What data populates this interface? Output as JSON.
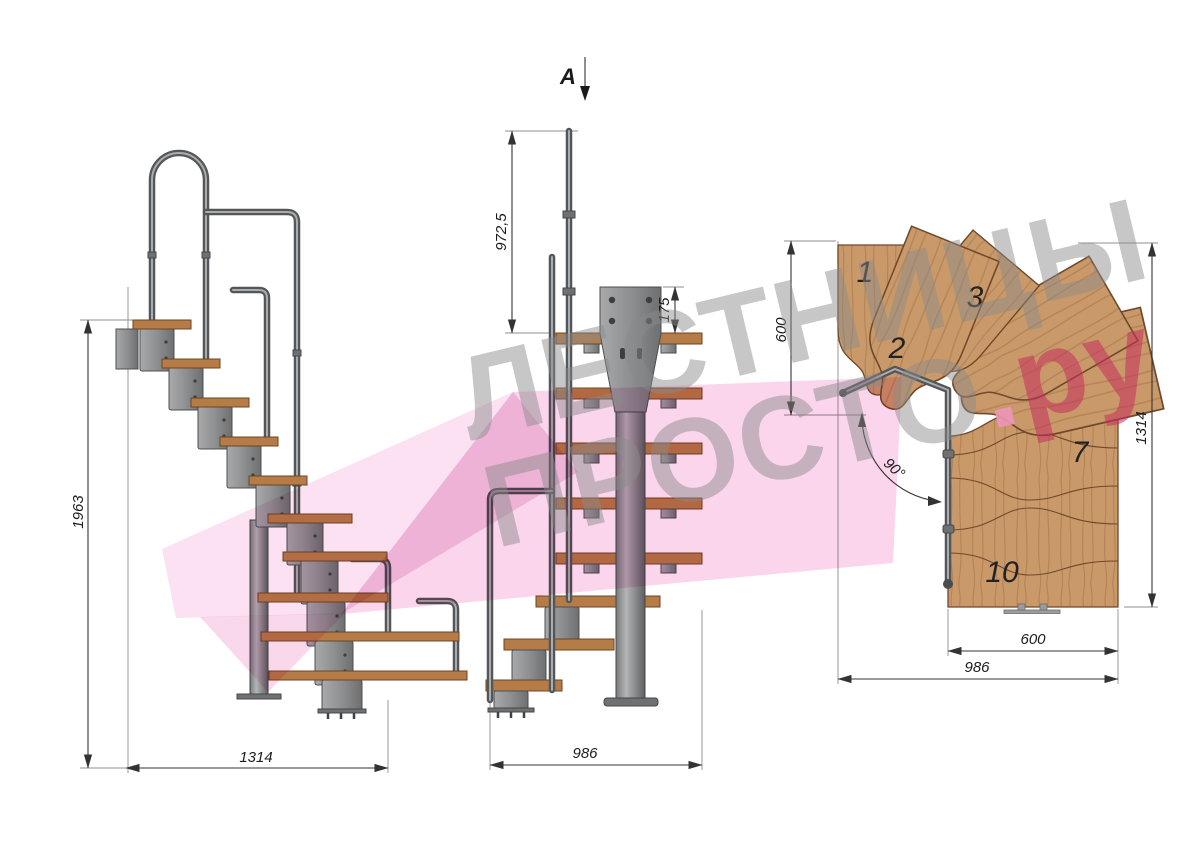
{
  "section_marker": {
    "label": "A"
  },
  "views": {
    "side": {
      "dim_height": "1963",
      "dim_run": "1314"
    },
    "front": {
      "dim_rail_height": "972,5",
      "dim_plate_offset": "175",
      "dim_width": "986"
    },
    "plan": {
      "dim_top_depth": "600",
      "dim_right_height": "1314",
      "dim_bottom_width": "600",
      "dim_overall_width": "986",
      "angle": "90°",
      "treads": {
        "t1": "1",
        "t2": "2",
        "t3": "3",
        "t7": "7",
        "t10": "10"
      }
    }
  },
  "watermark": {
    "line1": "ЛЕСТНИЦЫ",
    "line2": "ПРОСТО",
    "dot": ".",
    "suffix": "ру"
  },
  "colors": {
    "wood_plan": "#c9996a",
    "wood_side": "#b67c48",
    "metal": "#8e9092",
    "tube": "#54575a",
    "dim_text": "#1c1c1c",
    "watermark_gray": "#8a8a8a",
    "watermark_pink": "#c52d5c",
    "logo_shape_pink": "#f4aad7"
  }
}
